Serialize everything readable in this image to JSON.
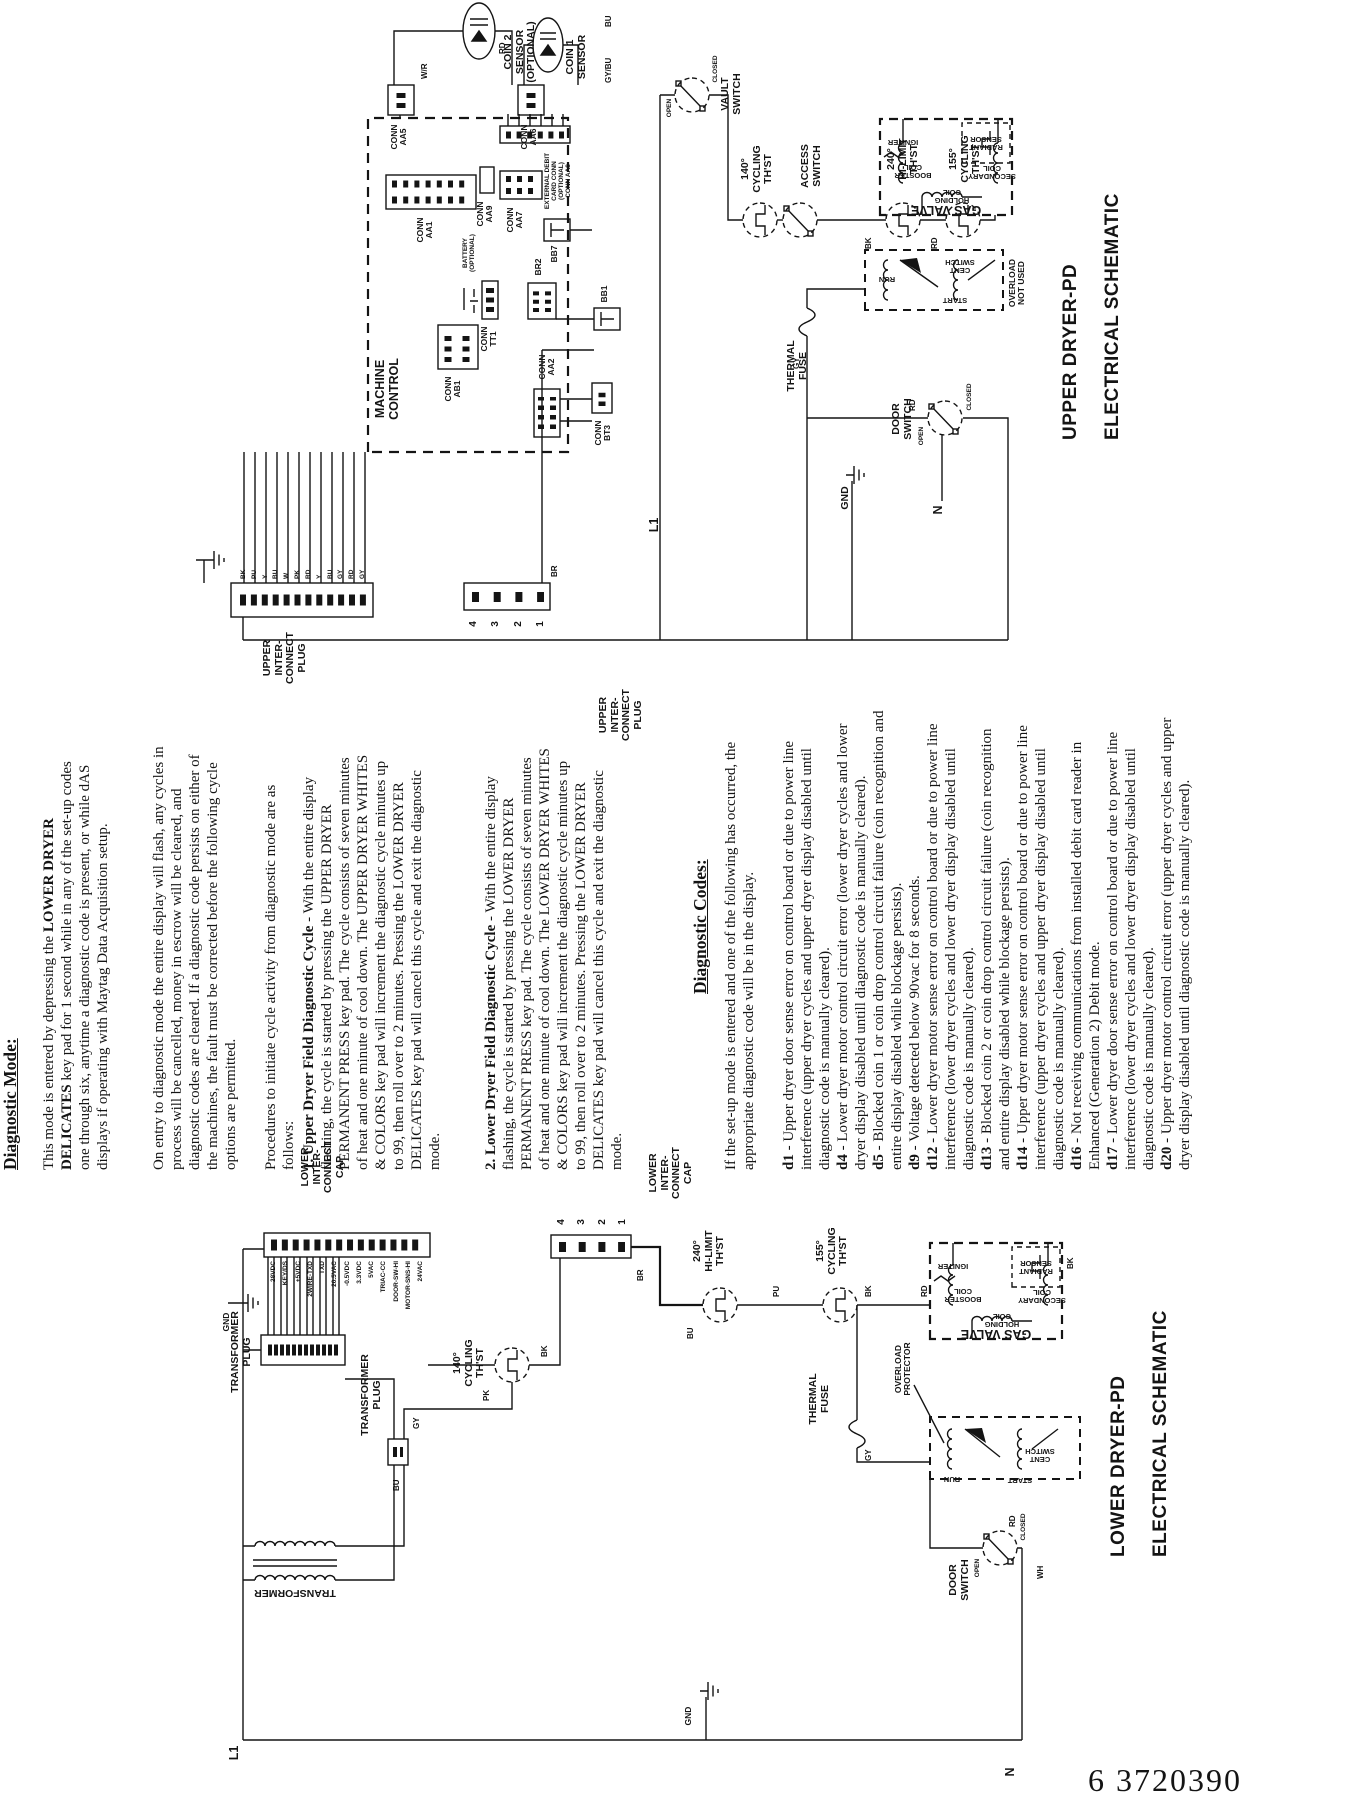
{
  "page_number": "6 3720390",
  "colors": {
    "ink": "#141414",
    "paper": "#ffffff"
  },
  "diagnostic_mode": {
    "heading": "Diagnostic Mode:",
    "p1_a": "This mode is entered by depressing the ",
    "p1_b": "LOWER DRYER DELICATES",
    "p1_c": " key pad for 1 second while in any of the set-up codes one through six, anytime a diagnostic code is present, or while dAS displays if operating with Maytag Data Acquisition setup.",
    "p2": "On entry to diagnostic mode the entire display will flash, any cycles in process will be cancelled, money in escrow will be cleared, and diagnostic codes are cleared. If a diagnostic code persists on either of the machines, the fault must be corrected before the following cycle options are permitted.",
    "procedures": "Procedures to initiate cycle activity from diagnostic mode are as follows:",
    "step1_lead": "1. Upper Dryer Field Diagnostic Cycle",
    "step1_rest": " - With the entire display flashing, the cycle is started by pressing the UPPER DRYER PERMANENT PRESS key pad. The cycle consists of seven minutes of heat and one minute of cool down. The UPPER DRYER WHITES & COLORS key pad will increment the diagnostic cycle minutes up to 99, then roll over to 2 minutes. Pressing the LOWER DRYER DELICATES key pad will cancel this cycle and exit the diagnostic mode.",
    "step2_lead": "2. Lower Dryer Field Diagnostic Cycle",
    "step2_rest": " - With the entire display flashing, the cycle is started by pressing the LOWER DRYER PERMANENT PRESS key pad. The cycle consists of seven minutes of heat and one minute of cool down. The LOWER DRYER WHITES & COLORS key pad will increment the diagnostic cycle minutes up to 99, then roll over to 2 minutes. Pressing the LOWER DRYER DELICATES key pad will cancel this cycle and exit the diagnostic mode."
  },
  "diagnostic_codes": {
    "heading": "Diagnostic Codes:",
    "intro": "If the set-up mode is entered and one of the following has occurred, the appropriate diagnostic code will be in the display.",
    "codes": [
      {
        "code": "d1",
        "text": " - Upper dryer door sense error on control board or due to power line interference (upper dryer cycles and upper dryer display disabled until diagnostic code is manually cleared)."
      },
      {
        "code": "d4",
        "text": " - Lower dryer motor control circuit error (lower dryer cycles and lower dryer display disabled untill diagnostic code is manually cleared)."
      },
      {
        "code": "d5",
        "text": " - Blocked coin 1 or coin drop control circuit failure (coin recognition and entire display disabled while blockage persists)."
      },
      {
        "code": "d9",
        "text": " - Voltage detected below 90vac for 8 seconds."
      },
      {
        "code": "d12",
        "text": " - Lower dryer motor sense error on control board or due to power line interference (lower dryer cycles and lower dryer display disabled until diagnostic code is manually cleared)."
      },
      {
        "code": "d13",
        "text": " - Blocked coin 2 or coin drop control circuit failure (coin recognition and entire display disabled while blockage persists)."
      },
      {
        "code": "d14",
        "text": " - Upper dryer motor sense error on control board or due to power line interference (upper dryer cycles and upper dryer display disabled until diagnostic code is manually cleared)."
      },
      {
        "code": "d16",
        "text": " - Not receiving communications from installed debit card reader in Enhanced (Generation 2) Debit mode."
      },
      {
        "code": "d17",
        "text": " - Lower dryer door sense error on control board or due to power line interference (lower dryer cycles and lower dryer display disabled until diagnostic code is manually cleared)."
      },
      {
        "code": "d20",
        "text": " - Upper dryer motor control circuit error (upper dryer cycles and upper dryer display disabled until diagnostic code is manually cleared)."
      }
    ]
  },
  "upper": {
    "title1": "UPPER  DRYER-PD",
    "title2": "ELECTRICAL SCHEMATIC",
    "interconnect_plug": "UPPER\nINTER-\nCONNECT\nPLUG",
    "machine_control": "MACHINE\nCONTROL",
    "coin2": "COIN 2\nSENSOR\n(OPTIONAL)",
    "coin1": "COIN 1\nSENSOR",
    "conn_aa5": "CONN\nAA5",
    "conn_aa6": "CONN\nAA6",
    "vault": "VAULT\nSWITCH",
    "access": "ACCESS\nSWITCH",
    "th140": "140°\nCYCLING\nTH'ST",
    "th240": "240°\nHI-LIMIT\nTH'ST",
    "th155": "155°\nCYCLING\nTH'ST",
    "gas_valve": "GAS VALVE",
    "holding": "HOLDING\nCOIL",
    "booster": "BOOSTER\nCOIL",
    "secondary": "SECONDARY\nCOIL",
    "igniter": "IGNITER",
    "radiant": "RADIANT\nSENSOR",
    "thermal_fuse": "THERMAL\nFUSE",
    "door": "DOOR\nSWITCH",
    "open": "OPEN",
    "closed": "CLOSED",
    "run": "RUN",
    "start": "START",
    "cent": "CENT\nSWITCH",
    "overload": "OVERLOAD\nNOT USED",
    "conn_aa1": "CONN\nAA1",
    "conn_tt1": "CONN\nTT1",
    "battery": "BATTERY\n(OPTIONAL)",
    "conn_aa7": "CONN\nAA7",
    "conn_aa8": "EXTERNAL DEBIT\nCARD CONN\n(OPTIONAL)\nCONN AA8",
    "conn_aa9": "CONN\nAA9",
    "conn_ab1": "CONN\nAB1",
    "br2": "BR2",
    "bb7": "BB7",
    "bb1": "BB1",
    "conn_aa2": "CONN\nAA2",
    "conn_bt3": "CONN\nBT3",
    "gnd": "GND",
    "l1": "L1",
    "n": "N",
    "plug12_wires": [
      "BK",
      "PU",
      "Y",
      "BU",
      "W",
      "PK",
      "RD",
      "Y",
      "BU",
      "GY",
      "RD",
      "GY"
    ],
    "plug4_pins": [
      "4",
      "3",
      "2",
      "1"
    ],
    "wire_br": "BR",
    "wire_bk": "BK",
    "wire_rd": "RD",
    "wire_bu": "BU",
    "wire_gy": "GY",
    "wire_wr": "W/R",
    "wire_gybu": "GY/BU"
  },
  "lower": {
    "title1": "LOWER  DRYER-PD",
    "title2": "ELECTRICAL SCHEMATIC",
    "interconnect_cap": "LOWER\nINTER-\nCONNECT\nCAP",
    "transformer_plug": "TRANSFORMER\nPLUG",
    "transformer": "TRANSFORMER",
    "th140": "140°\nCYCLING\nTH'ST",
    "th240": "240°\nHI-LIMIT\nTH'ST",
    "th155": "155°\nCYCLING\nTH'ST",
    "gas_valve": "GAS VALVE",
    "holding": "HOLDING\nCOIL",
    "booster": "BOOSTER\nCOIL",
    "secondary": "SECONDARY\nCOIL",
    "igniter": "IGNITER",
    "radiant": "RADIANT\nSENSOR",
    "thermal_fuse": "THERMAL\nFUSE",
    "door": "DOOR\nSWITCH",
    "open": "OPEN",
    "closed": "CLOSED",
    "run": "RUN",
    "start": "START",
    "cent": "CENT\nSWITCH",
    "overload": "OVERLOAD\nPROTECTOR",
    "gnd": "GND",
    "l1": "L1",
    "n": "N",
    "cap_signals": [
      "28VDC",
      "KEY/DS",
      "+5VDC",
      "2WIRE-TXD",
      "TXD",
      "20.5VAC",
      "-0.5VDC",
      "3.3VDC",
      "5VAC",
      "TRIAC-CC",
      "DOOR-SW-HI",
      "MOTOR-SNS-HI",
      "24VAC"
    ],
    "cap4_pins": [
      "4",
      "3",
      "2",
      "1"
    ],
    "wire_pk": "PK",
    "wire_bk": "BK",
    "wire_bu": "BU",
    "wire_pu": "PU",
    "wire_gy": "GY",
    "wire_rd": "RD",
    "wire_br": "BR",
    "wire_wh": "WH"
  }
}
